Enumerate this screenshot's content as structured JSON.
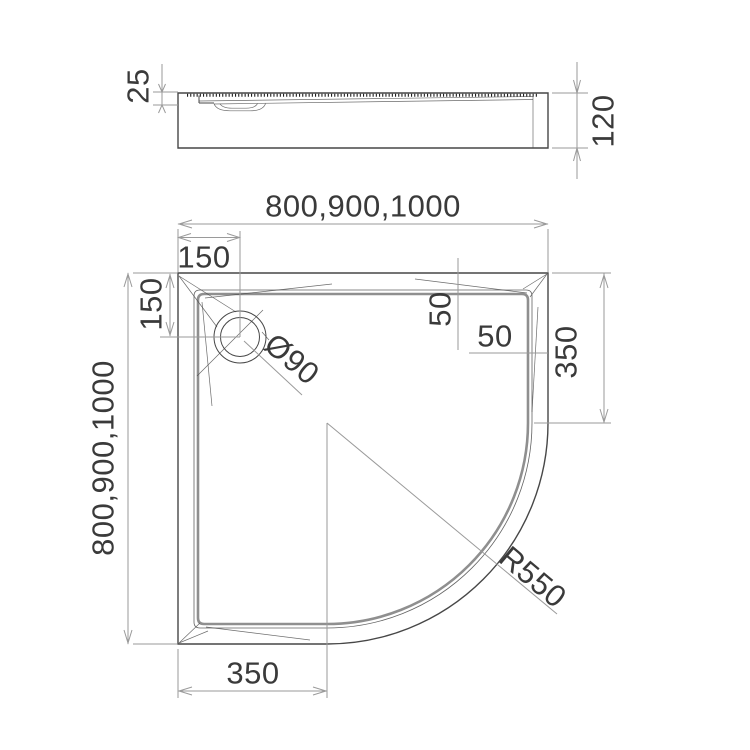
{
  "drawing_title": "quadrant shower tray technical drawing",
  "colors": {
    "line": "#474747",
    "dim": "#9a9a9a",
    "text": "#3a3a3a",
    "rim": "#8f8f8f",
    "bg": "#ffffff"
  },
  "side_view": {
    "labels": {
      "tray_depth": "25",
      "total_height": "120"
    }
  },
  "plan_view": {
    "labels": {
      "width_options": "800,900,1000",
      "depth_options": "800,900,1000",
      "drain_offset_top": "150",
      "drain_offset_left": "150",
      "drain_diameter": "Ø90",
      "rim_width_top": "50",
      "rim_width_right": "50",
      "straight_edge_right": "350",
      "straight_edge_bottom": "350",
      "corner_radius": "R550"
    }
  }
}
